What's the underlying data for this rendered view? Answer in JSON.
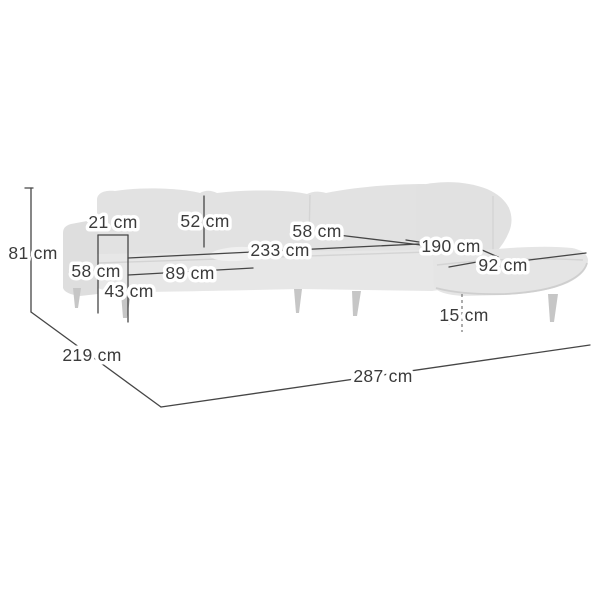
{
  "figure": {
    "type": "product-dimension-diagram",
    "subject": "corner-sofa-with-chaise",
    "unit": "cm",
    "colors": {
      "background": "#ffffff",
      "sofa_body": "#e3e3e3",
      "sofa_seat": "#e7e7e7",
      "sofa_armrest": "#dedede",
      "sofa_legs": "#c6c6c6",
      "dimension_line": "#464646",
      "label_text": "#3b3b3b",
      "label_halo": "#ffffff"
    }
  },
  "dimensions": [
    {
      "id": "overall-height",
      "label": "81 cm",
      "value": 81
    },
    {
      "id": "armrest-width",
      "label": "21 cm",
      "value": 21
    },
    {
      "id": "backrest-height",
      "label": "52 cm",
      "value": 52
    },
    {
      "id": "corner-seat-depth",
      "label": "58 cm",
      "value": 58
    },
    {
      "id": "seating-width",
      "label": "233 cm",
      "value": 233
    },
    {
      "id": "chaise-length",
      "label": "190 cm",
      "value": 190
    },
    {
      "id": "chaise-width",
      "label": "92 cm",
      "value": 92
    },
    {
      "id": "armrest-height",
      "label": "58 cm",
      "value": 58
    },
    {
      "id": "seat-depth",
      "label": "89 cm",
      "value": 89
    },
    {
      "id": "seat-height",
      "label": "43 cm",
      "value": 43
    },
    {
      "id": "leg-height",
      "label": "15 cm",
      "value": 15
    },
    {
      "id": "overall-depth",
      "label": "219 cm",
      "value": 219
    },
    {
      "id": "overall-width",
      "label": "287 cm",
      "value": 287
    }
  ]
}
